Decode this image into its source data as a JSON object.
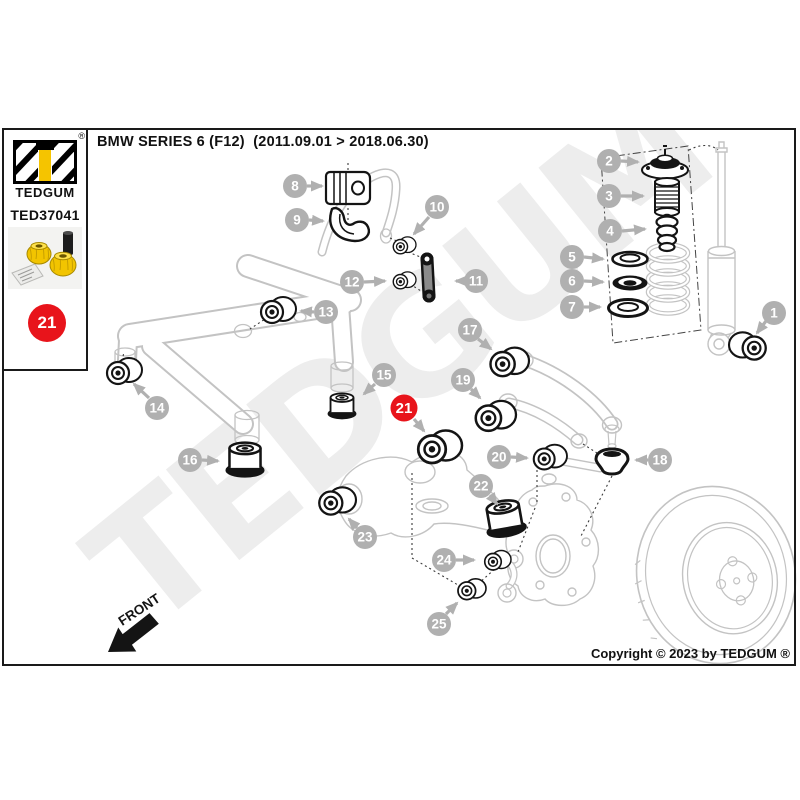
{
  "header": {
    "title": "BMW SERIES 6 (F12)  (2011.09.01 > 2018.06.30)"
  },
  "brand_panel": {
    "logo_name": "TEDGUM",
    "registered_mark": "®",
    "part_number": "TED37041",
    "product_photo": "yellow polyurethane bushing repair kit with sleeve and hardware packet",
    "position_badge": "21"
  },
  "watermark": {
    "text": "TEDGUM"
  },
  "diagram": {
    "front_label": "FRONT",
    "colors": {
      "highlight_red": "#e8141b",
      "callout_gray": "#b0b0b0",
      "outline_gray": "#c3c3c3",
      "part_yellow": "#f5c400",
      "ink": "#141414"
    },
    "callouts": [
      {
        "label": "1",
        "highlighted": false
      },
      {
        "label": "2",
        "highlighted": false
      },
      {
        "label": "3",
        "highlighted": false
      },
      {
        "label": "4",
        "highlighted": false
      },
      {
        "label": "5",
        "highlighted": false
      },
      {
        "label": "6",
        "highlighted": false
      },
      {
        "label": "7",
        "highlighted": false
      },
      {
        "label": "8",
        "highlighted": false
      },
      {
        "label": "9",
        "highlighted": false
      },
      {
        "label": "10",
        "highlighted": false
      },
      {
        "label": "11",
        "highlighted": false
      },
      {
        "label": "12",
        "highlighted": false
      },
      {
        "label": "13",
        "highlighted": false
      },
      {
        "label": "14",
        "highlighted": false
      },
      {
        "label": "15",
        "highlighted": false
      },
      {
        "label": "16",
        "highlighted": false
      },
      {
        "label": "17",
        "highlighted": false
      },
      {
        "label": "18",
        "highlighted": false
      },
      {
        "label": "19",
        "highlighted": false
      },
      {
        "label": "20",
        "highlighted": false
      },
      {
        "label": "21",
        "highlighted": true
      },
      {
        "label": "22",
        "highlighted": false
      },
      {
        "label": "23",
        "highlighted": false
      },
      {
        "label": "24",
        "highlighted": false
      },
      {
        "label": "25",
        "highlighted": false
      }
    ]
  },
  "footer": {
    "copyright": "Copyright © 2023 by TEDGUM ®"
  }
}
